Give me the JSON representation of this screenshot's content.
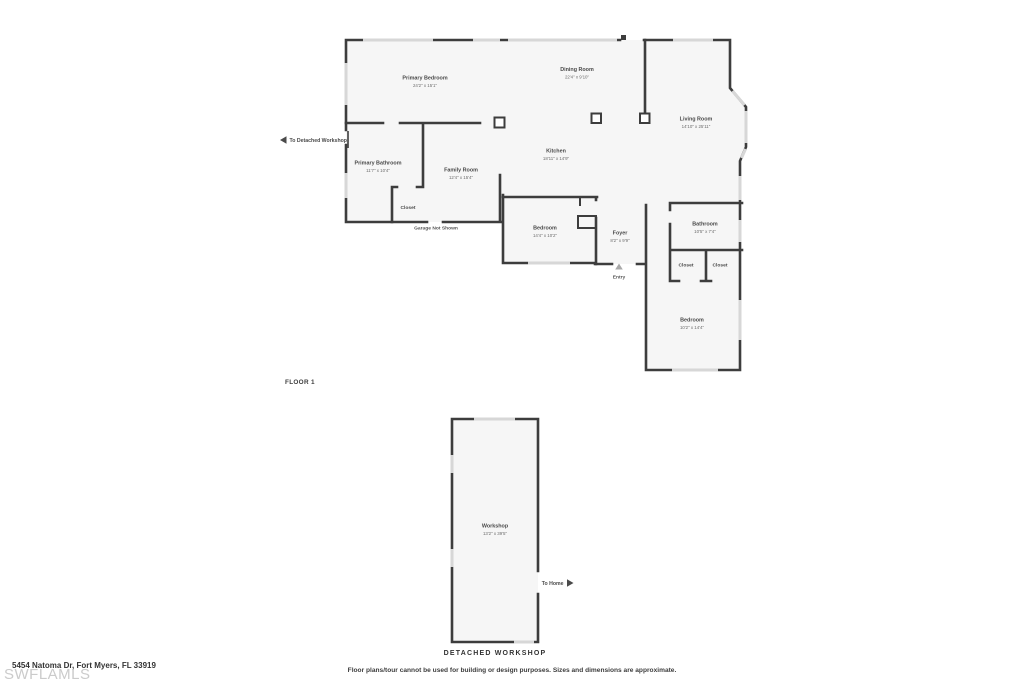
{
  "floor_plan": {
    "floor_label": "FLOOR 1",
    "rooms": {
      "primary_bedroom": {
        "name": "Primary Bedroom",
        "dims": "24'2\" x 15'1\""
      },
      "dining_room": {
        "name": "Dining Room",
        "dims": "22'4\" x 9'10\""
      },
      "living_room": {
        "name": "Living Room",
        "dims": "14'10\" x 25'11\""
      },
      "kitchen": {
        "name": "Kitchen",
        "dims": "18'11\" x 14'9\""
      },
      "primary_bathroom": {
        "name": "Primary Bathroom",
        "dims": "11'7\" x 10'4\""
      },
      "family_room": {
        "name": "Family Room",
        "dims": "12'4\" x 15'4\""
      },
      "closet_hall": {
        "name": "Closet"
      },
      "bedroom_middle": {
        "name": "Bedroom",
        "dims": "14'4\" x 10'2\""
      },
      "foyer": {
        "name": "Foyer",
        "dims": "8'2\" x 9'9\""
      },
      "bathroom": {
        "name": "Bathroom",
        "dims": "10'5\" x 7'4\""
      },
      "closet_left": {
        "name": "Closet"
      },
      "closet_right": {
        "name": "Closet"
      },
      "bedroom_right": {
        "name": "Bedroom",
        "dims": "10'2\" x 14'4\""
      }
    },
    "annotations": {
      "to_detached_workshop": "To Detached Workshop",
      "garage_not_shown": "Garage Not Shown",
      "entry": "Entry"
    }
  },
  "workshop_plan": {
    "room": {
      "name": "Workshop",
      "dims": "13'2\" x 39'5\""
    },
    "to_home": "To Home",
    "caption": "DETACHED WORKSHOP"
  },
  "footer": {
    "watermark": "SWFLAMLS",
    "address": "5454 Natoma Dr, Fort Myers, FL 33919",
    "disclaimer": "Floor plans/tour cannot be used for building or design purposes. Sizes and dimensions are approximate."
  },
  "colors": {
    "wall": "#3d3d3d",
    "room_fill": "#f6f6f6",
    "window": "#d7d7d7",
    "label_text": "#4a4a4a"
  }
}
